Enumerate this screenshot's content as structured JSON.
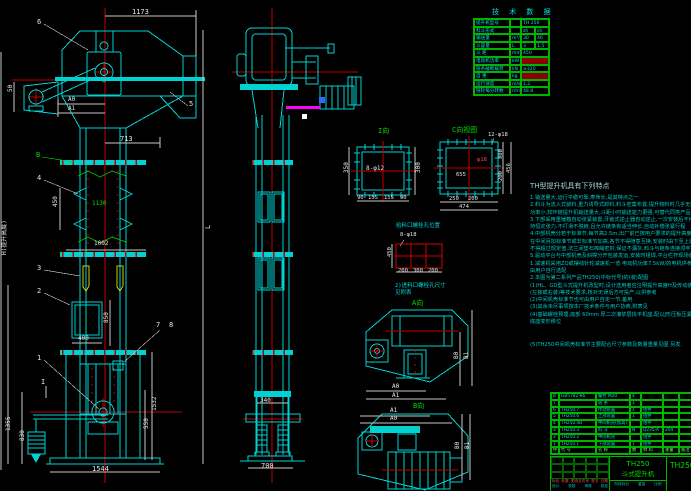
{
  "drawing": {
    "product_model": "TH250",
    "product_name": "斗式提升机",
    "drawing_no": "TH250",
    "stage_labels": [
      "阶段标记",
      "重量",
      "比例"
    ],
    "rev_labels": [
      "标记",
      "处数",
      "更改文件号",
      "签字",
      "日期"
    ],
    "sign_labels": [
      "设计",
      "校核",
      "审核",
      "批准"
    ]
  },
  "tech_table": {
    "title": "技 术 数 据",
    "rows": [
      {
        "l": "提升机型号",
        "u": "",
        "v": "TH 250",
        "red": false
      },
      {
        "l": "料斗形式",
        "u": "",
        "v": "zh",
        "v2": "sh",
        "red": false
      },
      {
        "l": "输送量",
        "u": "m³/h",
        "v": "30",
        "v2": "46",
        "red": false
      },
      {
        "l": "斗容量",
        "u": "L",
        "v": "3",
        "v2": "1.5",
        "red": false
      },
      {
        "l": "斗  距",
        "u": "mm",
        "v": "450",
        "red": false
      },
      {
        "l": "电动机功率",
        "u": "kW",
        "v": "",
        "red": true
      },
      {
        "l": "链条破断载荷",
        "u": "kN",
        "v": "≥320",
        "red": false
      },
      {
        "l": "自  重",
        "u": "kg",
        "v": "",
        "red": true
      },
      {
        "l": "运行速度",
        "u": "m/s",
        "v": "1.2",
        "red": false
      },
      {
        "l": "链轮每分转数",
        "u": "r/min",
        "v": "48.8",
        "red": false
      }
    ]
  },
  "bom": {
    "headers": [
      "件号",
      "代  号",
      "名  称",
      "数",
      "材  料",
      "重量",
      "备注"
    ],
    "rows": [
      [
        "8",
        "GB5782-86",
        "螺栓 M20",
        "4",
        "",
        "",
        ""
      ],
      [
        "7",
        "",
        "链  条",
        "1",
        "",
        "",
        ""
      ],
      [
        "6",
        "TH250.7",
        "传动装置",
        "1",
        "组件",
        "",
        ""
      ],
      [
        "5",
        "TH250.6",
        "上部装置",
        "1",
        "组件",
        "",
        ""
      ],
      [
        "4",
        "TH250.4B",
        "中间机壳(加高)",
        "",
        "组件",
        "",
        ""
      ],
      [
        "3",
        "TH250.3",
        "料  斗",
        "N",
        "Q235-A",
        "204",
        ""
      ],
      [
        "2",
        "TH250.2",
        "中间机壳",
        "",
        "组件",
        "",
        ""
      ],
      [
        "1",
        "TH250.1",
        "下部装置",
        "1",
        "组件",
        "",
        ""
      ]
    ]
  },
  "notes": {
    "title": "TH型提升机具有下列特点",
    "lines": [
      "1.输送量大,运行平稳可靠,寿命长,是其特点之一",
      "2.料斗为流入式装料,重力诱导式卸料,料斗密集布置,提升物料时几乎无回料和挖料现象,故无-P杂散",
      "  功率小,较环链提升机输送量大,斗距小时输送能力更强,可替代同类产品",
      "3.下部采用重锤箱自动张紧装置,牙嵌式逆止器自动逆止,一次安装后不用再调,运行中链条始终保",
      "  持恒定张力,不打滑不脱链,且允许链条有适当伸长,自动补偿张紧行程",
      "4.中部机壳分若干标准节,每节高2.5m,出厂前已按用户要求的提升高度H配齐,用户也可按工程需要",
      "  在中间另加标准节或非标准节加高,各节不得随意互换,安装时由下至上逐节找正,机壳中心偏差",
      "  不得超过规定值,法兰间垫石棉绳密封,保证不漏灰,料斗与链条连接须牢固不得松动",
      "5.驱动平台与中部机壳及斜撑分开包装发运,安装时组焊,平台栏杆现场装配,到货后请按装箱单清点",
      "1.减速机采用ZQ或摆线针轮减速机一览          电动机功率7.5kW/的电机供参考",
      "  由用户自行选配",
      "2.本图为第二系列产品TH250(中标代号)的(装)配图",
      "(1)HL、GD型斗式提升机改型时,设计选用者应注明提升高度H及传动装置布置形式",
      "   (左装或右装)等技术要求,核对无误后方可投产,以供参考",
      "(2)中间机壳标准节也可由用户自定一节,备用",
      "(3)其余未尽事项按本厂技术条件与用户协商,附表见",
      "(4)基础螺栓预埋,底部 60mm 厚二次灌浆层找平机座,配以J形压板压紧,以免受冲击时机壳",
      "   底座变形移位"
    ],
    "last_line": "(5)TH250中间机壳标准节主要配合尺寸参数及数量重量见图 另发."
  },
  "labels": [
    {
      "t": "1173",
      "x": 132,
      "y": 9,
      "c": "w"
    },
    {
      "t": "6",
      "x": 37,
      "y": 19,
      "c": "w",
      "n": "balloon-6"
    },
    {
      "t": "5",
      "x": 189,
      "y": 101,
      "c": "w",
      "n": "balloon-5"
    },
    {
      "t": "A0",
      "x": 68,
      "y": 97,
      "c": "w",
      "f": 6
    },
    {
      "t": "A1",
      "x": 68,
      "y": 106,
      "c": "w",
      "f": 6
    },
    {
      "t": "50",
      "x": 8,
      "y": 99,
      "c": "w",
      "f": 6,
      "r": 1
    },
    {
      "t": "713",
      "x": 120,
      "y": 136,
      "c": "w"
    },
    {
      "t": "B",
      "x": 36,
      "y": 152,
      "c": "g",
      "n": "balloon-b"
    },
    {
      "t": "4",
      "x": 37,
      "y": 175,
      "c": "w",
      "n": "balloon-4"
    },
    {
      "t": "450",
      "x": 53,
      "y": 214,
      "c": "w",
      "f": 6,
      "r": 1
    },
    {
      "t": "1130",
      "x": 92,
      "y": 201,
      "c": "g",
      "f": 6
    },
    {
      "t": "1002",
      "x": 94,
      "y": 241,
      "c": "w",
      "f": 6
    },
    {
      "t": "3",
      "x": 37,
      "y": 265,
      "c": "w",
      "n": "balloon-3"
    },
    {
      "t": "2",
      "x": 37,
      "y": 288,
      "c": "w",
      "n": "balloon-2"
    },
    {
      "t": "H(提升高度)",
      "x": 2,
      "y": 262,
      "c": "w",
      "f": 6,
      "r": 1
    },
    {
      "t": "400",
      "x": 78,
      "y": 336,
      "c": "w",
      "f": 6
    },
    {
      "t": "850",
      "x": 104,
      "y": 330,
      "c": "w",
      "f": 6,
      "r": 1
    },
    {
      "t": "7",
      "x": 156,
      "y": 322,
      "c": "w",
      "n": "balloon-7"
    },
    {
      "t": "8",
      "x": 169,
      "y": 322,
      "c": "w",
      "n": "balloon-8"
    },
    {
      "t": "1",
      "x": 37,
      "y": 355,
      "c": "w",
      "n": "balloon-1"
    },
    {
      "t": "I",
      "x": 41,
      "y": 379,
      "c": "w",
      "n": "section-mark-i"
    },
    {
      "t": "1532",
      "x": 152,
      "y": 418,
      "c": "w",
      "f": 6,
      "r": 1
    },
    {
      "t": "550",
      "x": 144,
      "y": 436,
      "c": "w",
      "f": 6,
      "r": 1
    },
    {
      "t": "1355",
      "x": 6,
      "y": 438,
      "c": "w",
      "f": 6,
      "r": 1
    },
    {
      "t": "830",
      "x": 20,
      "y": 448,
      "c": "w",
      "f": 6,
      "r": 1
    },
    {
      "t": "1544",
      "x": 92,
      "y": 466,
      "c": "w"
    },
    {
      "t": "L",
      "x": 205,
      "y": 236,
      "c": "w",
      "r": 1
    },
    {
      "t": "340",
      "x": 260,
      "y": 398,
      "c": "w",
      "f": 6
    },
    {
      "t": "700",
      "x": 261,
      "y": 463,
      "c": "w"
    },
    {
      "t": "I向",
      "x": 378,
      "y": 128,
      "c": "g",
      "n": "view-label-i"
    },
    {
      "t": "8-φ12",
      "x": 366,
      "y": 166,
      "c": "w",
      "f": 6
    },
    {
      "t": "350",
      "x": 344,
      "y": 180,
      "c": "w",
      "f": 6,
      "r": 1
    },
    {
      "t": "300",
      "x": 416,
      "y": 180,
      "c": "w",
      "f": 6,
      "r": 1
    },
    {
      "t": "90",
      "x": 357,
      "y": 196,
      "c": "w",
      "f": 5.5
    },
    {
      "t": "155",
      "x": 368,
      "y": 196,
      "c": "w",
      "f": 5.5
    },
    {
      "t": "155",
      "x": 384,
      "y": 196,
      "c": "w",
      "f": 5.5
    },
    {
      "t": "90",
      "x": 400,
      "y": 196,
      "c": "w",
      "f": 5.5
    },
    {
      "t": "C向视图",
      "x": 452,
      "y": 127,
      "c": "g",
      "n": "view-label-c"
    },
    {
      "t": "12-φ18",
      "x": 488,
      "y": 133,
      "c": "w",
      "f": 5.5
    },
    {
      "t": "φ18",
      "x": 477,
      "y": 158,
      "c": "r",
      "f": 5.5
    },
    {
      "t": "655",
      "x": 456,
      "y": 173,
      "c": "w",
      "f": 5.5
    },
    {
      "t": "250",
      "x": 449,
      "y": 197,
      "c": "w",
      "f": 5.5
    },
    {
      "t": "200",
      "x": 468,
      "y": 197,
      "c": "w",
      "f": 5.5
    },
    {
      "t": "474",
      "x": 459,
      "y": 205,
      "c": "w",
      "f": 5.5
    },
    {
      "t": "300",
      "x": 499,
      "y": 166,
      "c": "w",
      "f": 5.5,
      "r": 1
    },
    {
      "t": "200",
      "x": 499,
      "y": 188,
      "c": "w",
      "f": 5.5,
      "r": 1
    },
    {
      "t": "456",
      "x": 507,
      "y": 180,
      "c": "w",
      "f": 5.5,
      "r": 1
    },
    {
      "t": "给料口螺栓孔位置",
      "x": 396,
      "y": 224,
      "c": "c",
      "f": 5.5
    },
    {
      "t": "8-φ18",
      "x": 400,
      "y": 233,
      "c": "w",
      "f": 5.5
    },
    {
      "t": "450",
      "x": 388,
      "y": 264,
      "c": "w",
      "f": 5.5,
      "r": 1
    },
    {
      "t": "200",
      "x": 398,
      "y": 269,
      "c": "w",
      "f": 5.5
    },
    {
      "t": "300",
      "x": 413,
      "y": 269,
      "c": "w",
      "f": 5.5
    },
    {
      "t": "200",
      "x": 428,
      "y": 269,
      "c": "w",
      "f": 5.5
    },
    {
      "t": "2)进料口螺栓孔尺寸",
      "x": 395,
      "y": 284,
      "c": "c",
      "f": 5.5
    },
    {
      "t": "见附表",
      "x": 395,
      "y": 291,
      "c": "c",
      "f": 5.5
    },
    {
      "t": "A向",
      "x": 412,
      "y": 300,
      "c": "g",
      "n": "view-label-a"
    },
    {
      "t": "A0",
      "x": 392,
      "y": 384,
      "c": "w",
      "f": 6
    },
    {
      "t": "A1",
      "x": 392,
      "y": 393,
      "c": "w",
      "f": 6
    },
    {
      "t": "B0",
      "x": 454,
      "y": 366,
      "c": "w",
      "f": 6,
      "r": 1
    },
    {
      "t": "B1",
      "x": 464,
      "y": 366,
      "c": "w",
      "f": 6,
      "r": 1
    },
    {
      "t": "B向",
      "x": 413,
      "y": 403,
      "c": "g",
      "n": "view-label-b"
    },
    {
      "t": "A1",
      "x": 390,
      "y": 408,
      "c": "w",
      "f": 6
    },
    {
      "t": "A0",
      "x": 390,
      "y": 416,
      "c": "w",
      "f": 6
    },
    {
      "t": "B0",
      "x": 455,
      "y": 456,
      "c": "w",
      "f": 6,
      "r": 1
    },
    {
      "t": "B1",
      "x": 465,
      "y": 456,
      "c": "w",
      "f": 6,
      "r": 1
    }
  ]
}
